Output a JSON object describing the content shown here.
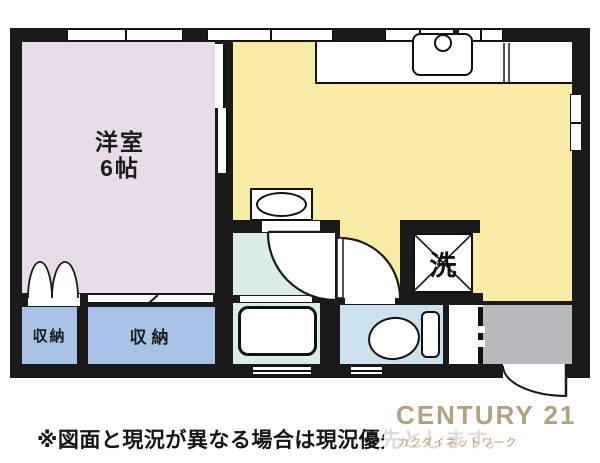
{
  "plan": {
    "rooms": {
      "western_room": {
        "name": "洋室",
        "size": "6帖"
      },
      "closet_left": {
        "label": "収納"
      },
      "closet_right": {
        "label": "収納"
      },
      "laundry": {
        "label": "洗"
      }
    },
    "colors": {
      "wall": "#1a1a1a",
      "western_room": "#e9dbe9",
      "kitchen": "#f8eca4",
      "closet": "#a8c2e5",
      "bath": "#d9ece8",
      "toilet": "#cbe2ee",
      "entrance": "#b9b9bd",
      "logo_brand": "#b2a27d",
      "logo_company": "#c9995d"
    }
  },
  "footer": {
    "disclaimer": "※図面と現況が異なる場合は現況優先とします。"
  },
  "logo": {
    "brand": "CENTURY 21",
    "company": "カクダイネットワーク"
  }
}
